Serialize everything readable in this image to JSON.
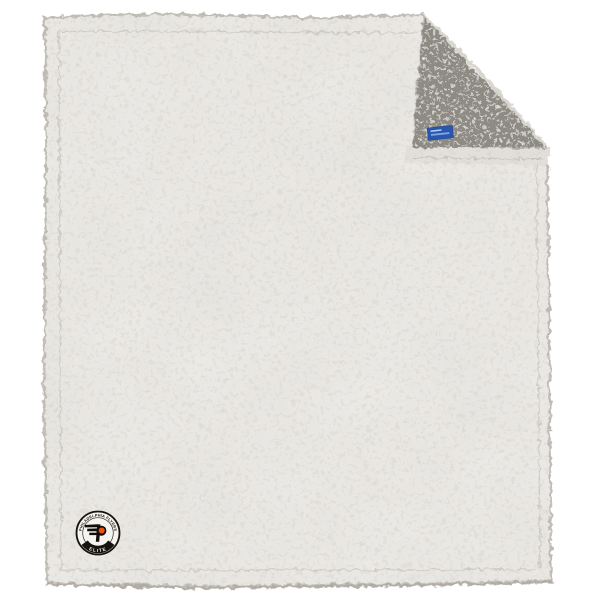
{
  "scene": {
    "background_color": "#ffffff",
    "blanket": {
      "front_color": "#eceae6",
      "front_speckle_color": "#a8a39b",
      "reverse_color": "#8f8b83",
      "reverse_speckle_dark": "#45423c",
      "reverse_speckle_light": "#d9d6d0",
      "hem_color": "#e4e1dc",
      "edge_trim_color": "#bdb9b2"
    },
    "tag": {
      "color": "#2a57ae"
    },
    "logo_patch": {
      "top_text": "PHILADELPHIA FLYERS",
      "bottom_text": "ELITE",
      "ring_color": "#17140f",
      "background_color": "#f6f4f0",
      "emblem_black": "#100d0a",
      "emblem_orange": "#f0500f"
    }
  }
}
